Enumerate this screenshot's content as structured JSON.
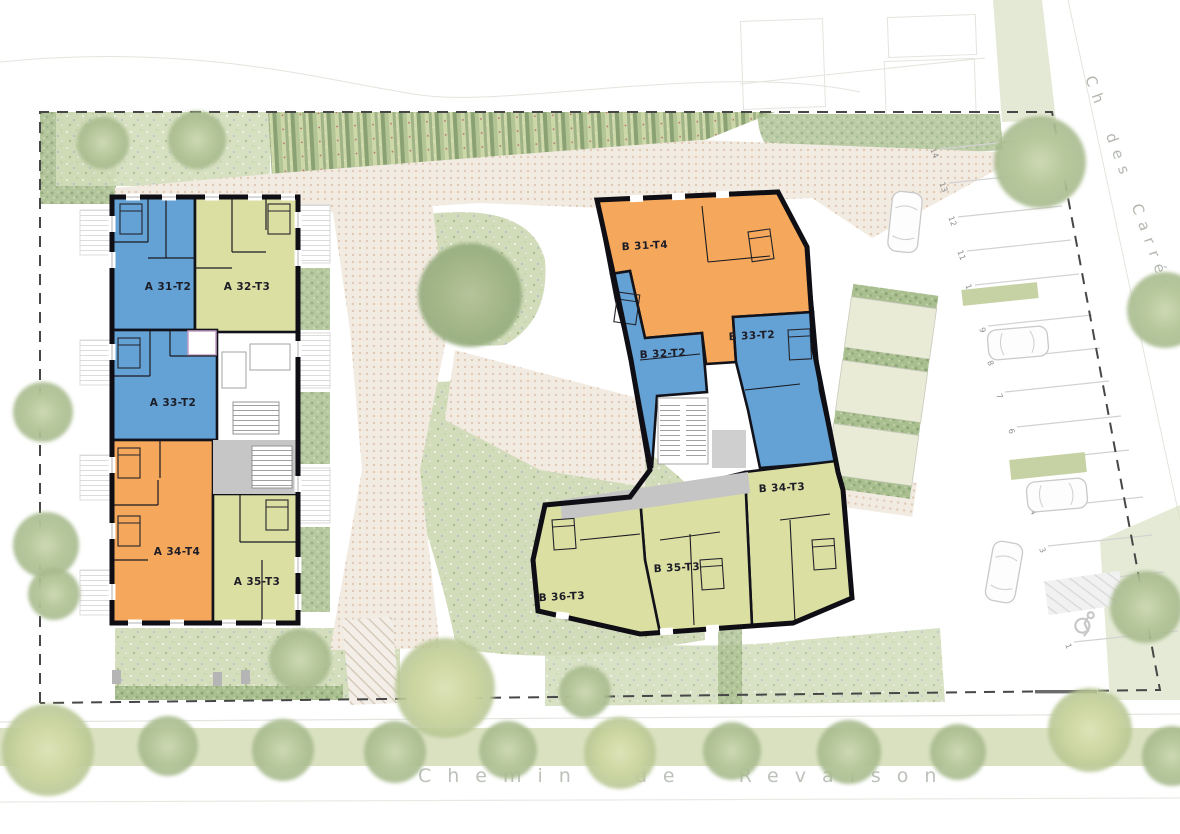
{
  "plan": {
    "streets": {
      "right_street": "Ch des Carrés",
      "bottom_street": "Chemin de Revaison"
    },
    "buildings": {
      "a": {
        "units": [
          {
            "label": "A 31-T2",
            "type": "T2"
          },
          {
            "label": "A 32-T3",
            "type": "T3"
          },
          {
            "label": "A 33-T2",
            "type": "T2"
          },
          {
            "label": "A 34-T4",
            "type": "T4"
          },
          {
            "label": "A 35-T3",
            "type": "T3"
          }
        ]
      },
      "b": {
        "units": [
          {
            "label": "B 31-T4",
            "type": "T4"
          },
          {
            "label": "B 32-T2",
            "type": "T2"
          },
          {
            "label": "B 33-T2",
            "type": "T2"
          },
          {
            "label": "B 34-T3",
            "type": "T3"
          },
          {
            "label": "B 35-T3",
            "type": "T3"
          },
          {
            "label": "B 36-T3",
            "type": "T3"
          }
        ]
      }
    },
    "unit_colors": {
      "T2": "#64a1d4",
      "T3": "#dcdfa2",
      "T4": "#f5a85b"
    },
    "parking": {
      "spaces": [
        "1",
        "2",
        "3",
        "4",
        "5",
        "6",
        "7",
        "8",
        "9",
        "10",
        "11",
        "12",
        "13",
        "14"
      ],
      "accessible_space": "1"
    }
  }
}
